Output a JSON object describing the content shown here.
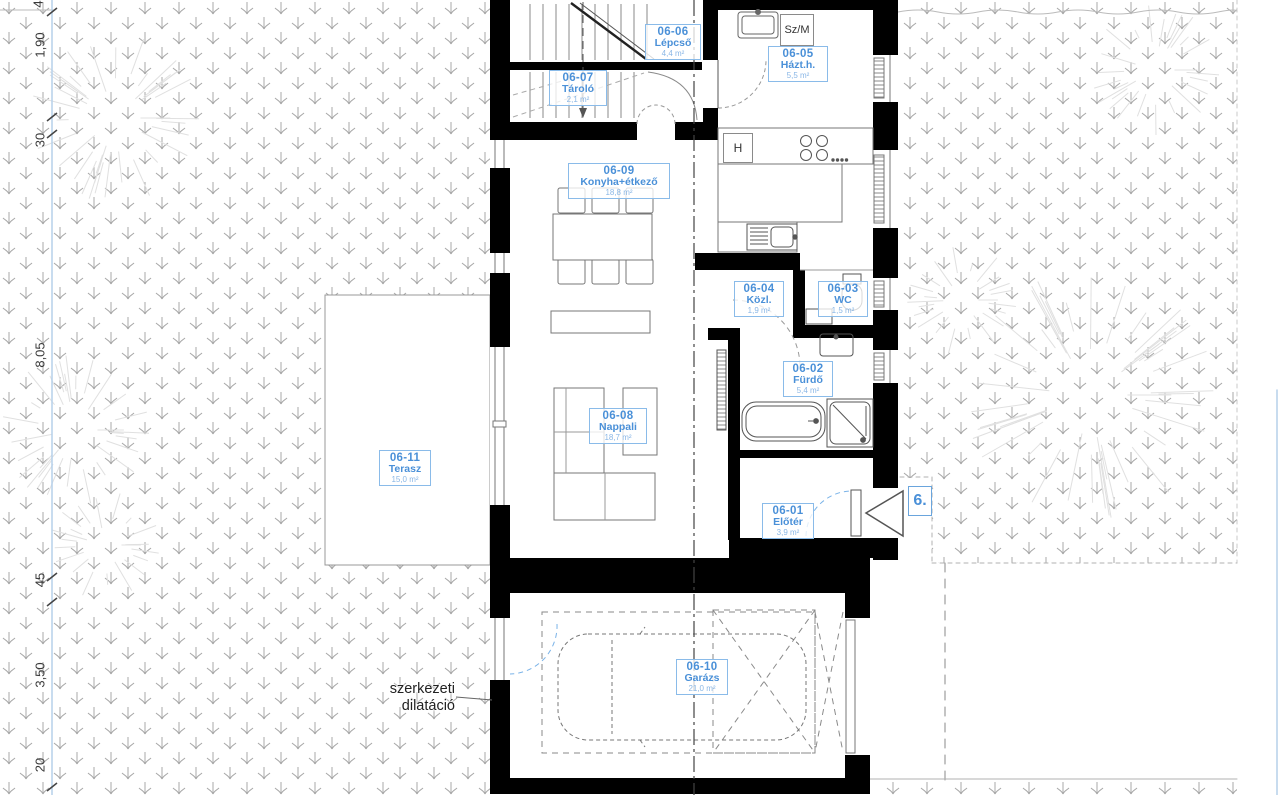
{
  "rooms": [
    {
      "code": "06-01",
      "name": "Előtér",
      "area": "3,9 m²"
    },
    {
      "code": "06-02",
      "name": "Fürdő",
      "area": "5,4 m²"
    },
    {
      "code": "06-03",
      "name": "WC",
      "area": "1,5 m²"
    },
    {
      "code": "06-04",
      "name": "Közl.",
      "area": "1,9 m²"
    },
    {
      "code": "06-05",
      "name": "Házt.h.",
      "area": "5,5 m²"
    },
    {
      "code": "06-06",
      "name": "Lépcső",
      "area": "4,4 m²"
    },
    {
      "code": "06-07",
      "name": "Tároló",
      "area": "2,1 m²"
    },
    {
      "code": "06-08",
      "name": "Nappali",
      "area": "18,7 m²"
    },
    {
      "code": "06-09",
      "name": "Konyha+étkező",
      "area": "18,8 m²"
    },
    {
      "code": "06-10",
      "name": "Garázs",
      "area": "21,0 m²"
    },
    {
      "code": "06-11",
      "name": "Terasz",
      "area": "15,0 m²"
    }
  ],
  "dimensions": {
    "left": [
      "4",
      "1,90",
      "30",
      "8,05",
      "45",
      "3,50",
      "20"
    ]
  },
  "annotations": {
    "structural_note_line1": "szerkezeti",
    "structural_note_line2": "dilatáció",
    "entry_marker": "6.",
    "washer_label": "Sz/M",
    "fridge_label": "H"
  },
  "colors": {
    "label_blue": "#4a90d8",
    "label_border": "#8abbe9",
    "area_blue": "#8ab7e6",
    "wall_black": "#000000",
    "hatch_gray": "#a8a8a8",
    "dim_blue": "#b5d0ea",
    "door_arc_blue": "#7ab3e8"
  }
}
